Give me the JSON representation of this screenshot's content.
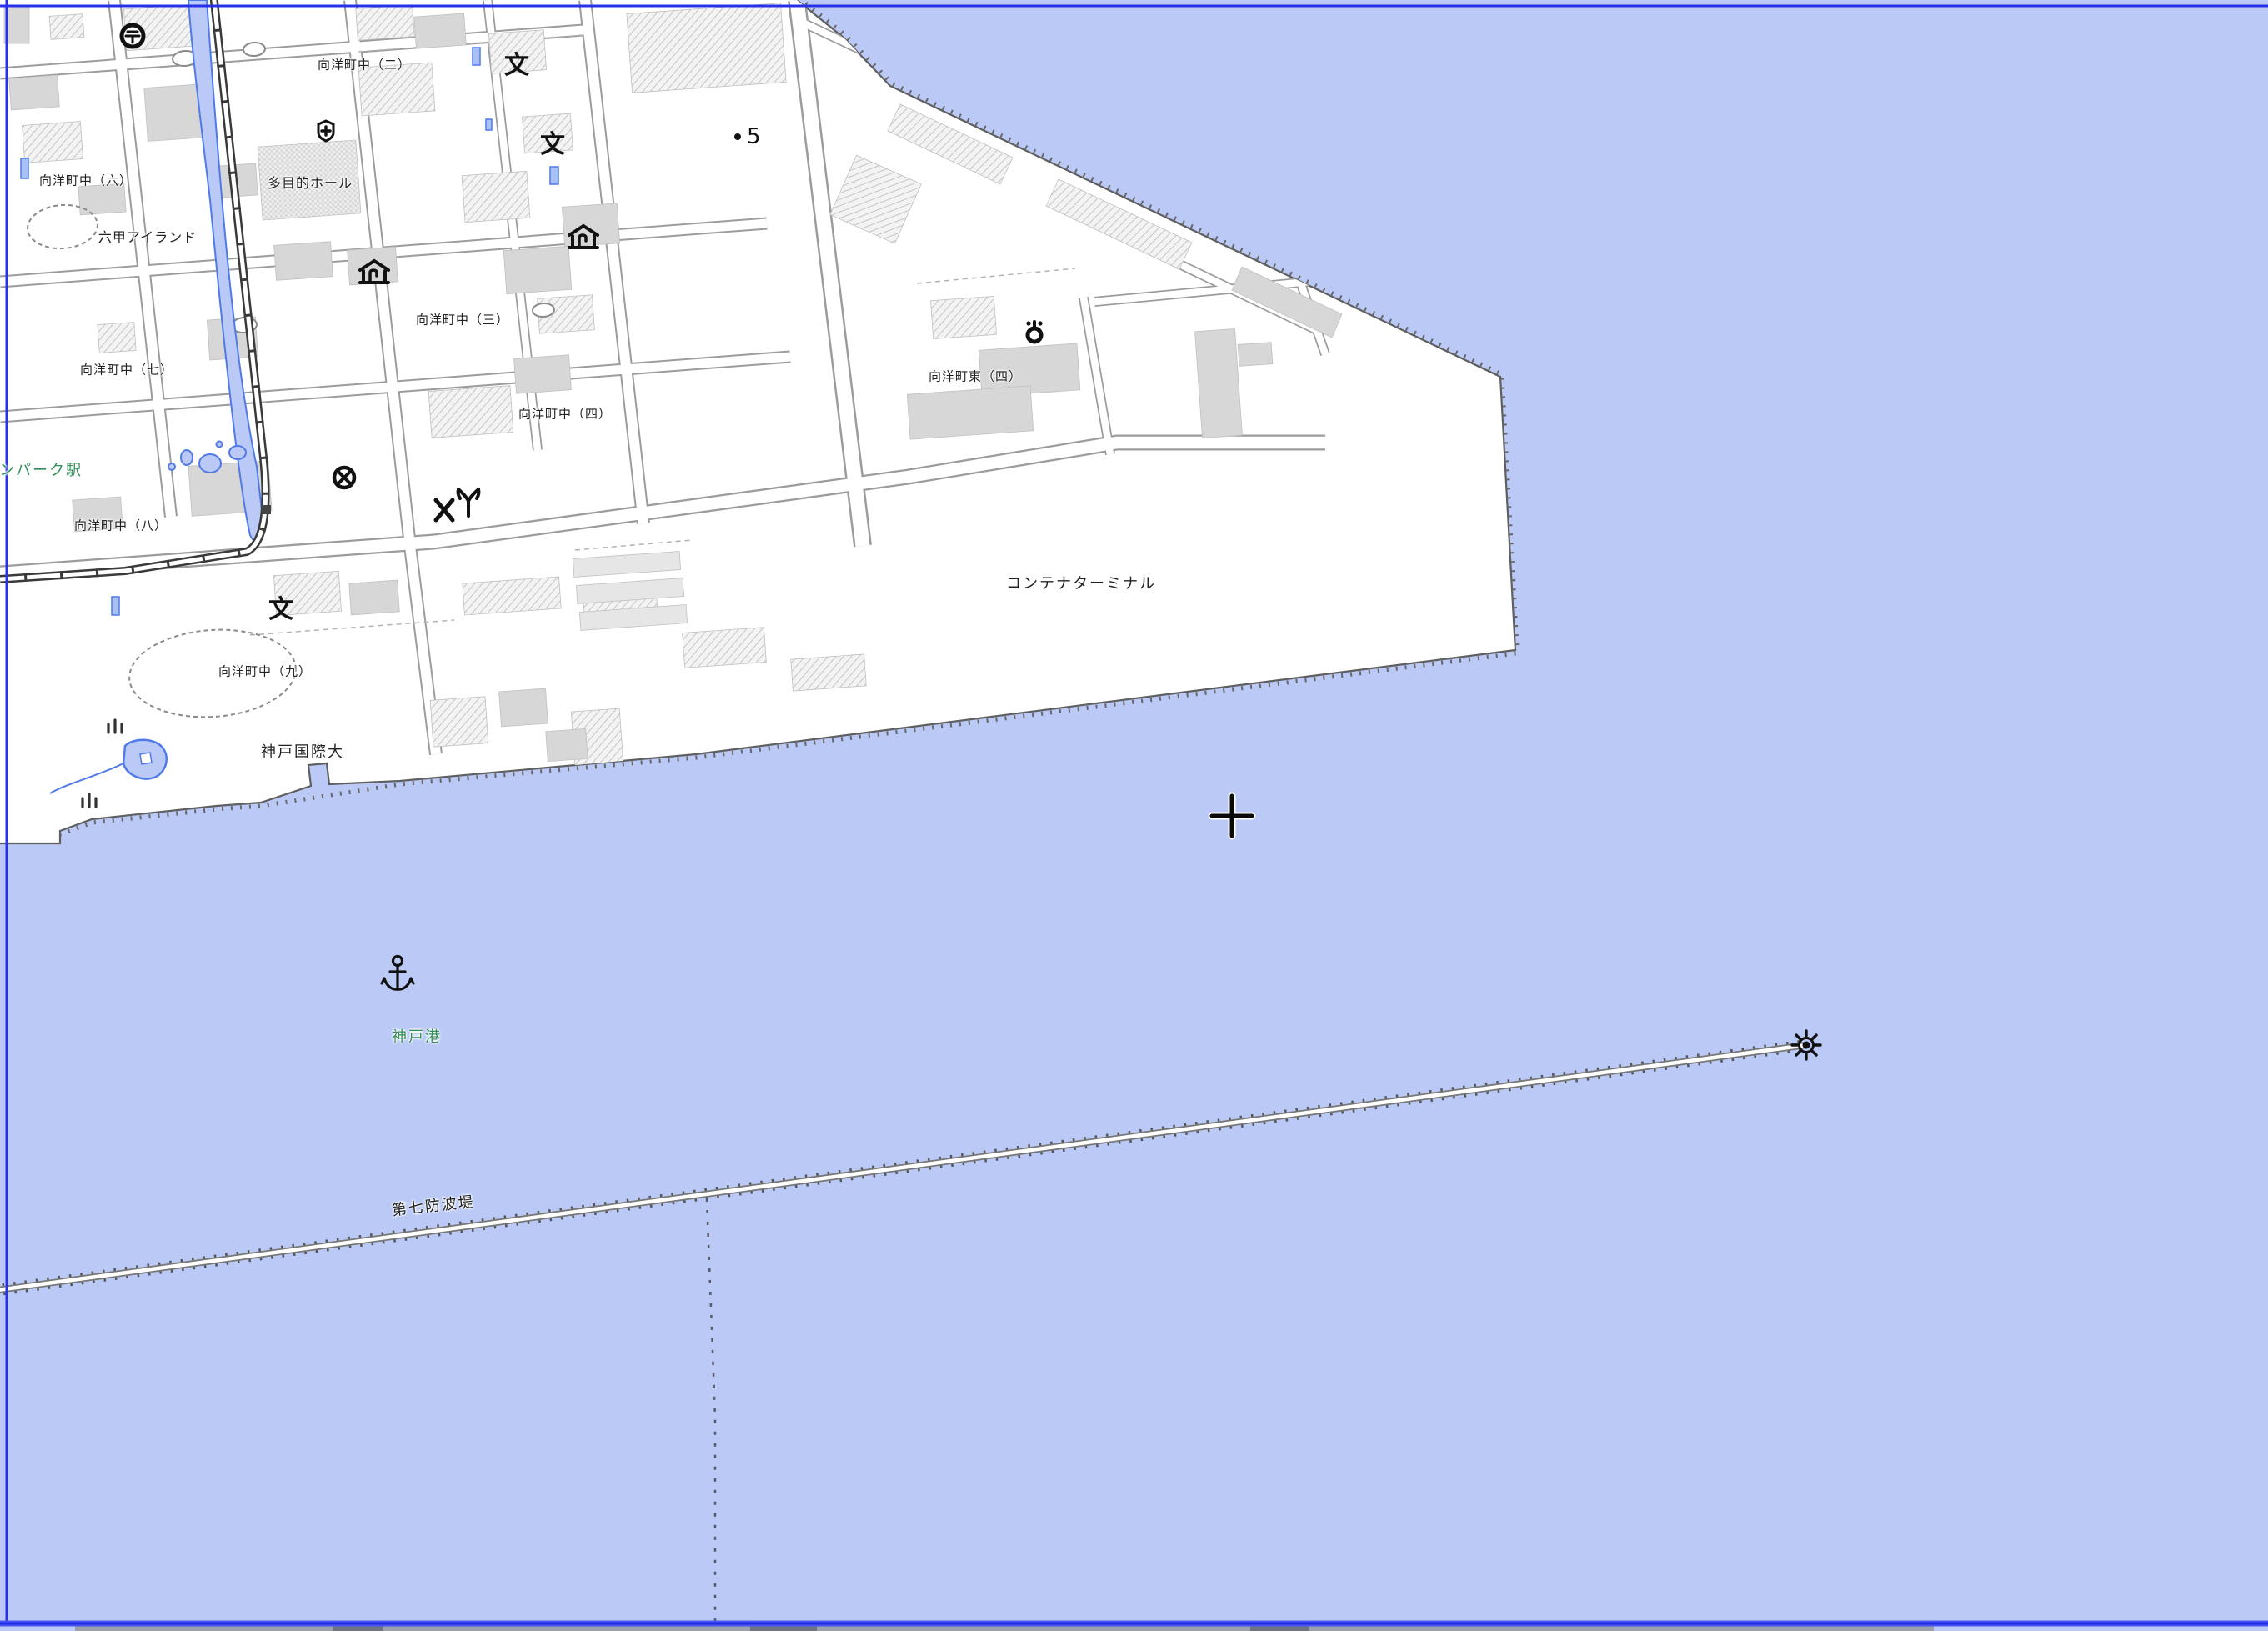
{
  "map": {
    "labels": {
      "koyocho_naka_2": "向洋町中（二）",
      "tamokuteki_hall": "多目的ホール",
      "koyocho_naka_6": "向洋町中（六）",
      "rokko_island": "六甲アイランド",
      "koyocho_naka_3": "向洋町中（三）",
      "koyocho_naka_7": "向洋町中（七）",
      "koyocho_naka_4": "向洋町中（四）",
      "koyocho_higashi_4": "向洋町東（四）",
      "container_terminal": "コンテナターミナル",
      "koyocho_naka_8": "向洋町中（八）",
      "marine_park_station_partial": "ンパーク駅",
      "koyocho_naka_9": "向洋町中（九）",
      "kobe_international_university": "神戸国際大",
      "kobe_port": "神戸港",
      "breakwater_no7": "第七防波堤"
    },
    "spot_elevation": {
      "value": "5"
    },
    "icons": {
      "school_glyph": "文",
      "post_office": "post-office-icon",
      "hospital": "hospital-icon",
      "museum": "museum-icon",
      "police_station": "police-station-icon",
      "police_box": "police-box-icon",
      "fire_station": "fire-station-icon",
      "power_substation": "power-substation-icon",
      "anchor": "anchor-icon",
      "lighthouse": "lighthouse-icon",
      "cemetery": "cemetery-icon",
      "grid_cross": "grid-cross-icon"
    },
    "colors": {
      "water": "#bac9f6",
      "land": "#ffffff",
      "neatline_blue": "#2631e8",
      "green_label": "#2f8f58",
      "black_label": "#222222",
      "building_gray": "#d7d7d7",
      "water_outline": "#4f7ae8",
      "street_line": "#9c9c9c"
    }
  }
}
